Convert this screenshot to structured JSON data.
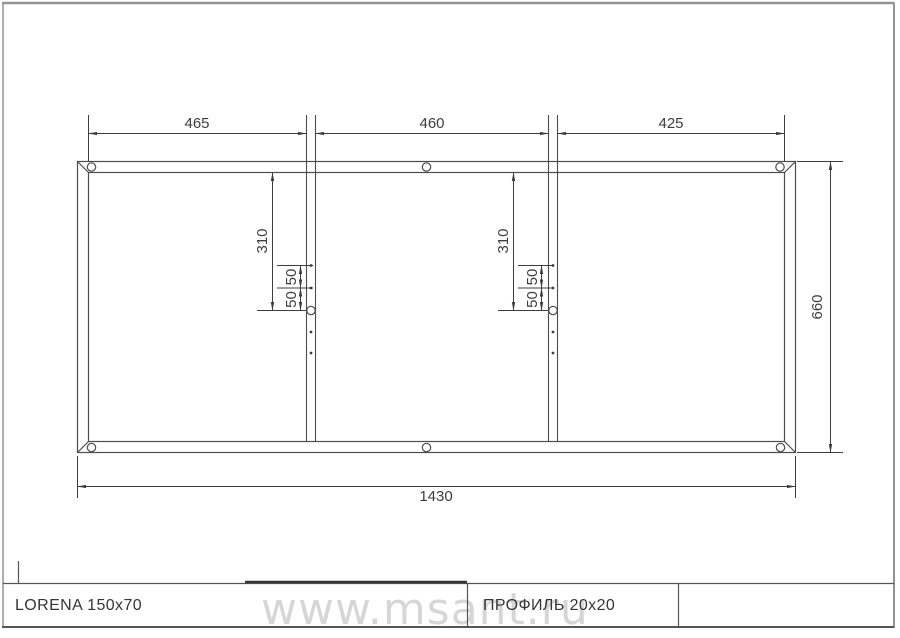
{
  "sheet": {
    "watermark": "www.msant.ru"
  },
  "title_block": {
    "product_name": "LORENA 150x70",
    "profile_spec": "ПРОФИЛЬ 20x20",
    "third_cell": ""
  },
  "dimensions": {
    "top_section_1": "465",
    "top_section_2": "460",
    "top_section_3": "425",
    "overall_length": "1430",
    "overall_height": "660",
    "crossbar_hole_offset": "310",
    "hole_spacing": "50"
  },
  "drawing_meta": {
    "frame_sections": 3,
    "crossbars": 2,
    "corner_holes": 6,
    "crossbar_center_holes": 2
  },
  "colors": {
    "drawing_line": "#4d4d4d",
    "sheet_border": "#949494",
    "watermark_text": "#d6d6d6",
    "label_text": "#3d3d3d"
  }
}
